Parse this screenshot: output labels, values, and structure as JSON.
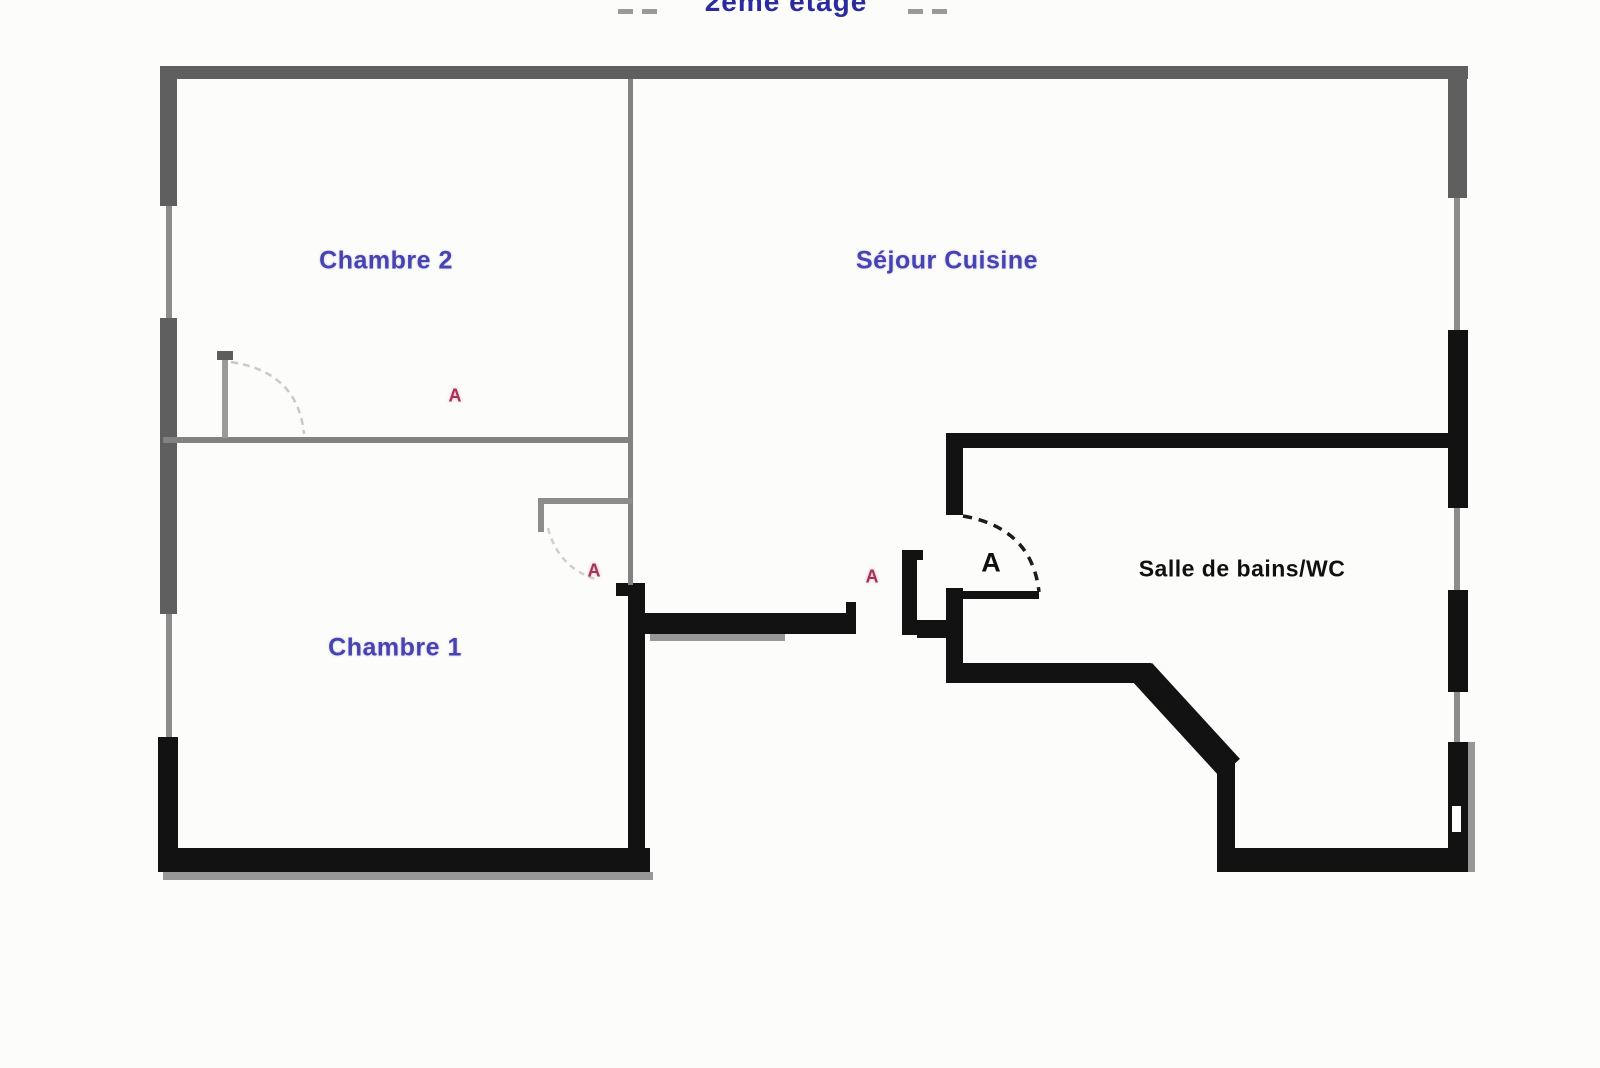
{
  "title": {
    "text": "2ème étage"
  },
  "rooms": {
    "chambre2": {
      "label": "Chambre 2"
    },
    "sejour_cuisine": {
      "label": "Séjour Cuisine"
    },
    "chambre1": {
      "label": "Chambre 1"
    },
    "salle_de_bains": {
      "label": "Salle de bains/WC"
    }
  },
  "markers": {
    "chambre2_point": {
      "letter": "A"
    },
    "chambre1_point": {
      "letter": "A"
    },
    "hall_point": {
      "letter": "A"
    },
    "bathroom_point": {
      "letter": "A"
    }
  },
  "colors": {
    "room_label": "#4743b0",
    "title_color": "#2b2b9e",
    "marker_red": "#a63355",
    "wall_black": "#121212",
    "wall_gray": "#5f5f5f",
    "wall_thin": "#8c8c8c",
    "shadow_gray": "#979797"
  }
}
